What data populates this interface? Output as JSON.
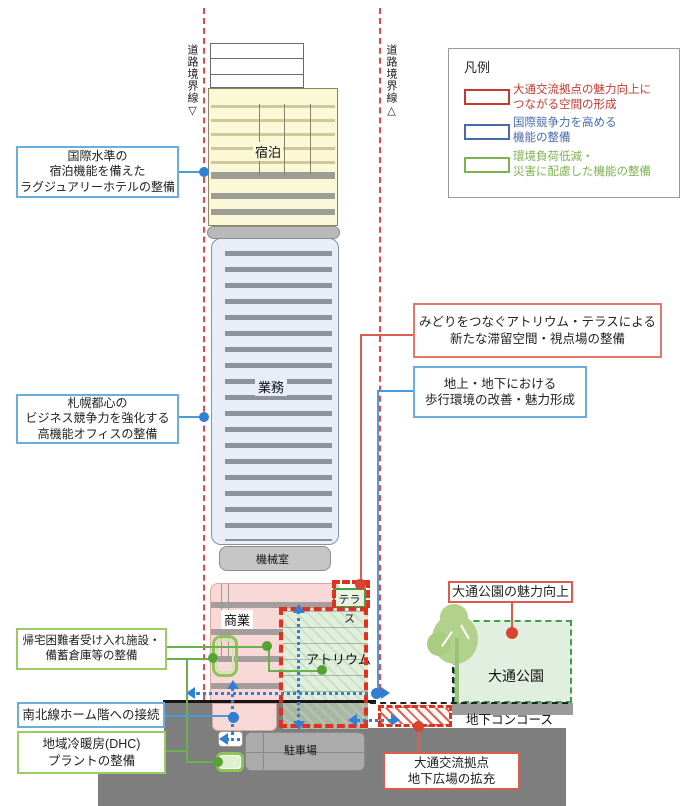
{
  "boundary": {
    "left": "道路境界線▽",
    "right": "道路境界線△"
  },
  "legend": {
    "title": "凡例",
    "items": [
      {
        "line1": "大通交流拠点の魅力向上に",
        "line2": "つながる空間の形成",
        "color": "#c7392f"
      },
      {
        "line1": "国際競争力を高める",
        "line2": "機能の整備",
        "color": "#4a6bab"
      },
      {
        "line1": "環境負荷低減・",
        "line2": "災害に配慮した機能の整備",
        "color": "#7cb34f"
      }
    ]
  },
  "building": {
    "hotel": "宿泊",
    "office": "業務",
    "machine": "機械室",
    "commercial": "商業",
    "atrium": "アトリウム",
    "terrace": "テラス",
    "parking": "駐車場"
  },
  "site": {
    "park": "大通公園",
    "concourse": "地下コンコース"
  },
  "callouts": {
    "hotel": {
      "line1": "国際水準の",
      "line2": "宿泊機能を備えた",
      "line3": "ラグジュアリーホテルの整備"
    },
    "office": {
      "line1": "札幌都心の",
      "line2": "ビジネス競争力を強化する",
      "line3": "高機能オフィスの整備"
    },
    "shelter": {
      "line1": "帰宅困難者受け入れ施設・",
      "line2": "備蓄倉庫等の整備"
    },
    "subway": {
      "line1": "南北線ホーム階への接続"
    },
    "dhc": {
      "line1": "地域冷暖房(DHC)",
      "line2": "プラントの整備"
    },
    "terrace": {
      "line1": "みどりをつなぐアトリウム・テラスによる",
      "line2": "新たな滞留空間・視点場の整備"
    },
    "walk": {
      "line1": "地上・地下における",
      "line2": "歩行環境の改善・魅力形成"
    },
    "park": {
      "line1": "大通公園の魅力向上"
    },
    "plaza": {
      "line1": "大通交流拠点",
      "line2": "地下広場の拡充"
    }
  },
  "colors": {
    "category_red": "#c7392f",
    "category_blue": "#4a6bab",
    "category_green": "#7cb34f",
    "boundary_line": "#e84848",
    "flow_arrow_blue": "#2f7fd6",
    "atrium_outline_red": "#e0301e"
  }
}
